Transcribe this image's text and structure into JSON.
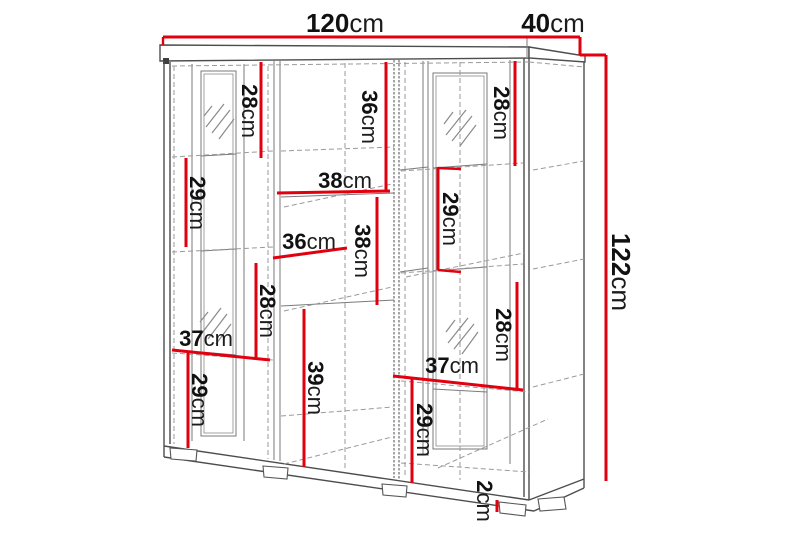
{
  "diagram": {
    "type": "cabinet-dimension-diagram",
    "unit": "cm",
    "background": "#ffffff",
    "colors": {
      "dimension_line": "#e2000f",
      "edge_line": "#4d4d4d",
      "hidden_edge_line": "#9a9a9a",
      "label_text": "#111111"
    },
    "overall": {
      "width": {
        "id": "overall-width",
        "value": "120"
      },
      "depth": {
        "id": "overall-depth",
        "value": "40"
      },
      "height": {
        "id": "overall-height",
        "value": "122"
      }
    },
    "internal": [
      {
        "id": "left-column-top-section-height",
        "value": "28"
      },
      {
        "id": "middle-column-top-section-height",
        "value": "36"
      },
      {
        "id": "right-column-top-section-height",
        "value": "28"
      },
      {
        "id": "left-column-second-section-height",
        "value": "29"
      },
      {
        "id": "middle-shelf-width-upper",
        "value": "38"
      },
      {
        "id": "right-column-second-section-height",
        "value": "29"
      },
      {
        "id": "middle-shelf-width-lower",
        "value": "36"
      },
      {
        "id": "middle-column-middle-section-height",
        "value": "38"
      },
      {
        "id": "left-column-third-section-height",
        "value": "28"
      },
      {
        "id": "right-column-third-section-height",
        "value": "28"
      },
      {
        "id": "left-shelf-width",
        "value": "37"
      },
      {
        "id": "right-shelf-width",
        "value": "37"
      },
      {
        "id": "middle-column-bottom-section-height",
        "value": "39"
      },
      {
        "id": "left-column-bottom-section-height",
        "value": "29"
      },
      {
        "id": "right-column-bottom-section-height",
        "value": "29"
      },
      {
        "id": "plinth-foot-height",
        "value": "2"
      }
    ]
  }
}
